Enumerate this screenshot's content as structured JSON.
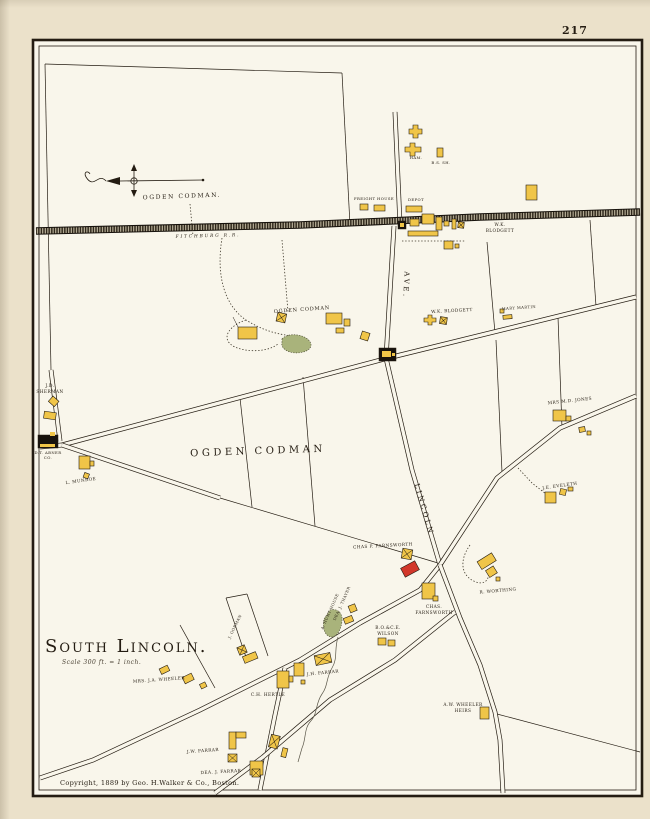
{
  "page": {
    "number": "217",
    "copyright": "Copyright, 1889 by Geo. H.Walker & Co., Boston."
  },
  "title": {
    "text": "South Lincoln.",
    "scale_note": "Scale 300 ft. = 1 inch."
  },
  "colors": {
    "paper": "#ebe1ca",
    "map_background": "#f9f6eb",
    "ink": "#241c12",
    "building_yellow": "#f0c548",
    "building_red": "#d2372a",
    "building_black": "#17120c",
    "pond_green": "#a9b37b"
  },
  "streets": {
    "lincoln": "LINCOLN",
    "ave": "AVE.",
    "railroad": "FITCHBURG R.R."
  },
  "station": {
    "freight_house": "FREIGHT HOUSE",
    "depot": "DEPOT",
    "ham": "HAM.",
    "blacksmith_shop": "B.S. SH."
  },
  "owners": {
    "ogden_codman_top": "OGDEN CODMAN.",
    "ogden_codman_mid": "OGDEN CODMAN",
    "ogden_codman_large": "OGDEN CODMAN",
    "wk_blodgett_station_l1": "W.K.",
    "wk_blodgett_station_l2": "BLODGETT",
    "wk_blodgett_south": "W.K. BLODGETT",
    "mary_martin": "MARY MARTIN",
    "jd_sherman_l1": "J.D.",
    "jd_sherman_l2": "SHERMAN",
    "abner_l1": "D.T. ABNER",
    "abner_l2": "CO.",
    "l_munroe": "L. MUNROE",
    "mrs_md_jones": "MRS M.D. JONES",
    "je_eveleth": "J.E. EVELETH",
    "chas_p_farnsworth": "CHAS P. FARNSWORTH",
    "r_worthing": "R. WORTHING",
    "chas_farnsworth_l1": "CHAS.",
    "chas_farnsworth_l2": "FARNSWORTH",
    "wilson_l1": "B.O.&C.E.",
    "wilson_l2": "WILSON",
    "hunt_house": "A. HUNT HOUSE",
    "dea_thayer": "DEA. J. THAYER",
    "gorman": "J. GORMAN",
    "ch_hertle": "C.H. HERTLE",
    "jh_farrar": "J.H. FARRAR",
    "mrs_ja_wheeler": "MRS. J.A. WHEELER",
    "aw_wheeler_l1": "A.W. WHEELER",
    "aw_wheeler_l2": "HEIRS",
    "jw_farrar": "J.W. FARRAR",
    "dea_j_farrar": "DEA. J. FARRAR"
  }
}
